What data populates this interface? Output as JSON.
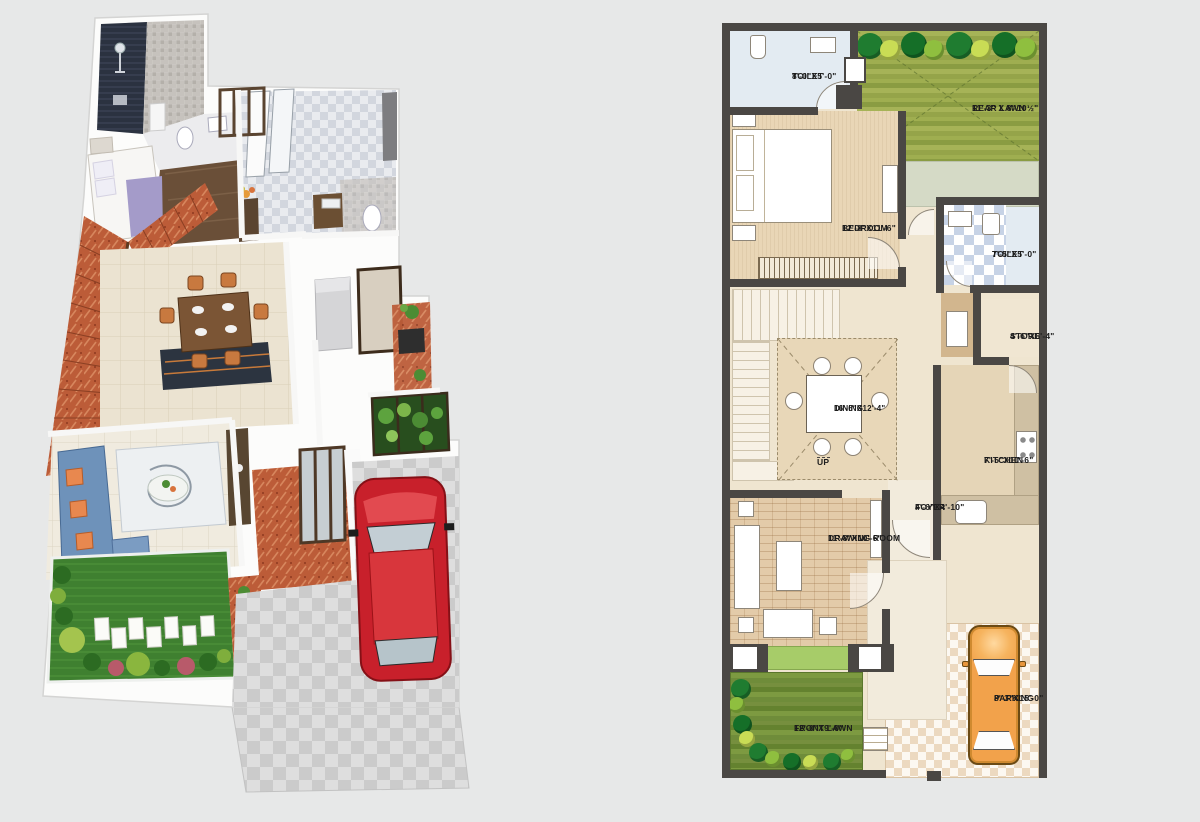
{
  "canvas": {
    "width": 1200,
    "height": 822,
    "background": "#e7e8e8"
  },
  "view3d": {
    "name": "3D isometric house rendering",
    "colors": {
      "walls": "#fcfcfb",
      "shower_tile": "#2b3240",
      "mosaic_wall": "#c6c2bd",
      "bath_floor": "#e9ebef",
      "wood_floor": "#6a4f38",
      "stairs_marble": "#bc5c38",
      "dining_floor": "#ebe3d1",
      "dining_table": "#7b5535",
      "chairs": "#c8793f",
      "sofa": "#6e92ba",
      "cushions": "#e8884f",
      "lawn": "#3f8030",
      "car": "#c8202b",
      "driveway": "#dedede"
    }
  },
  "plan2d": {
    "up_label": "UP",
    "rooms": [
      {
        "id": "toilet-top",
        "label": "TOILET",
        "dims": "8'-0\"X5'-0\""
      },
      {
        "id": "rear-lawn",
        "label": "REAR LAWN",
        "dims": "11'-3\" X 8'-10½\""
      },
      {
        "id": "bedroom",
        "label": "BEDROOM",
        "dims": "12'-8\"X11'-6\""
      },
      {
        "id": "toilet-mid",
        "label": "TOILET",
        "dims": "7'-5\"X5'-0\""
      },
      {
        "id": "store",
        "label": "STORE",
        "dims": "4'-6\"X6'-4\""
      },
      {
        "id": "dining",
        "label": "DINING",
        "dims": "16'-6\"X12'-4\""
      },
      {
        "id": "kitchen",
        "label": "KITCHEN",
        "dims": "7'-5\"X10'-6\""
      },
      {
        "id": "foyer",
        "label": "FOYER",
        "dims": "4'-6\"X4'-10\""
      },
      {
        "id": "drawing-room",
        "label": "DRAWING ROOM",
        "dims": "11'-8\"X10'-6\""
      },
      {
        "id": "front-lawn",
        "label": "FRONT LAWN",
        "dims": "12'-0\"X9'-0\""
      },
      {
        "id": "parking",
        "label": "PARKING",
        "dims": "8'-3\"X15'-0\""
      }
    ],
    "colors": {
      "wall": "#4a4744",
      "floor_base": "#efe5d0",
      "bedroom_floor": "#e9d6b6",
      "dining_floor": "#e8d7b8",
      "rear_lawn": "#95a449",
      "front_lawn": "#6f8c3a",
      "porch_green": "#a7cc69",
      "toilet_tile": "#c7d3e6",
      "parking_tile": "#ecd9c0",
      "kitchen_counter": "#cfc0a3",
      "passage": "#d5dac6",
      "car": "#f2a24b",
      "veranda": "#f2ebdc"
    }
  }
}
